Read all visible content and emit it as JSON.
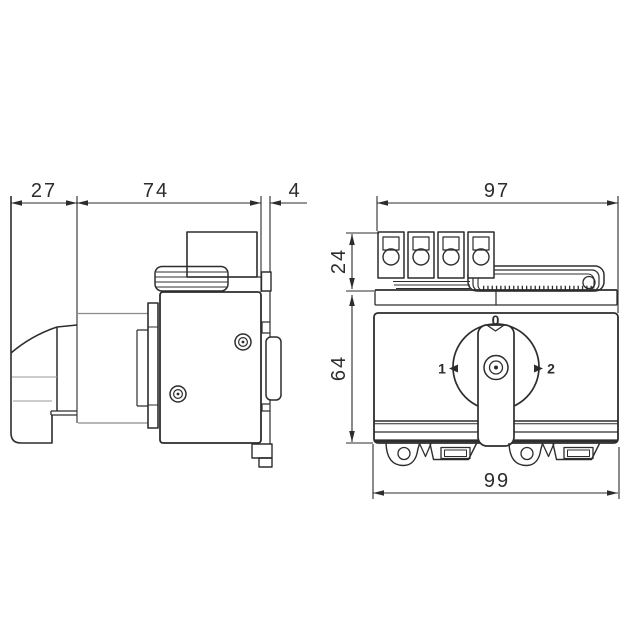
{
  "page": {
    "background": "#ffffff"
  },
  "drawing": {
    "type": "technical-dimension-drawing",
    "subject": "rotary-changeover-switch-two-views",
    "views": {
      "side": {
        "dimensions": {
          "handle_depth": "27",
          "body_depth": "74",
          "rail_plate": "4"
        }
      },
      "front": {
        "dimensions": {
          "top_width": "97",
          "terminal_height": "24",
          "body_height": "64",
          "bottom_width": "99"
        },
        "knob_positions": {
          "top": "0",
          "left": "1",
          "right": "2"
        }
      }
    },
    "colors": {
      "outline": "#2d2d2d",
      "dimension": "#2c2c2c",
      "light_line": "#9a9a9a"
    }
  }
}
